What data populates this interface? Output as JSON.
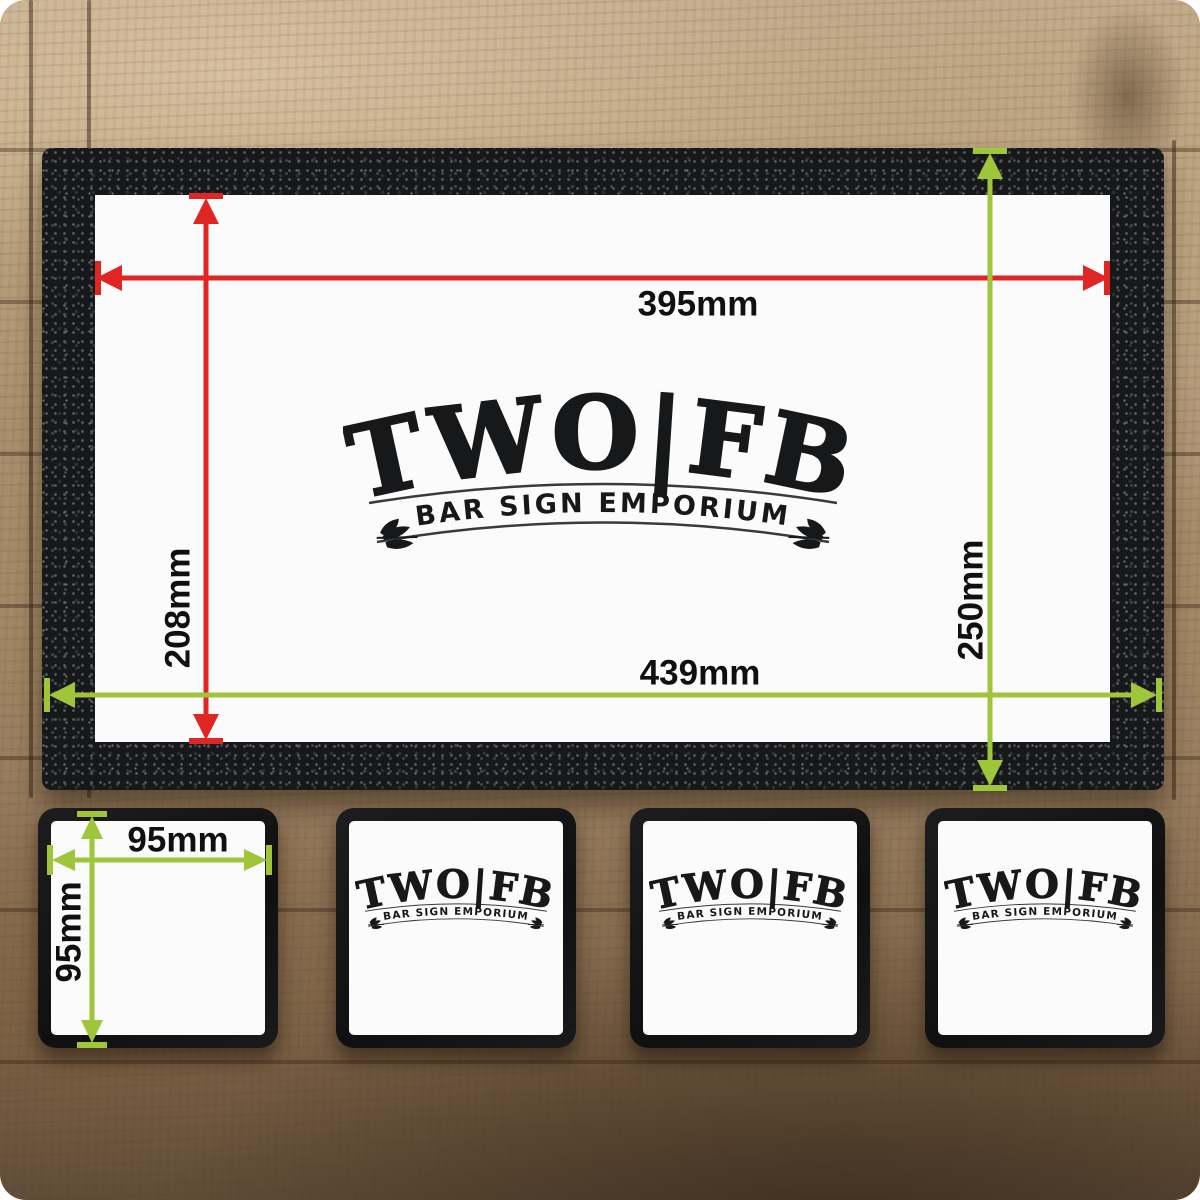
{
  "logo": {
    "brand": "TWO|FB",
    "tagline": "BAR SIGN EMPORIUM"
  },
  "bar_runner": {
    "print_area": {
      "width": "395mm",
      "height": "208mm"
    },
    "overall": {
      "width": "439mm",
      "height": "250mm"
    }
  },
  "coasters": {
    "count": 4,
    "size": {
      "width": "95mm",
      "height": "95mm"
    },
    "first_shows": "dimensions",
    "others_show": "logo"
  },
  "colors": {
    "dim_inner": "#e02525",
    "dim_outer": "#9fc63b",
    "logo_ink": "#17181a"
  }
}
